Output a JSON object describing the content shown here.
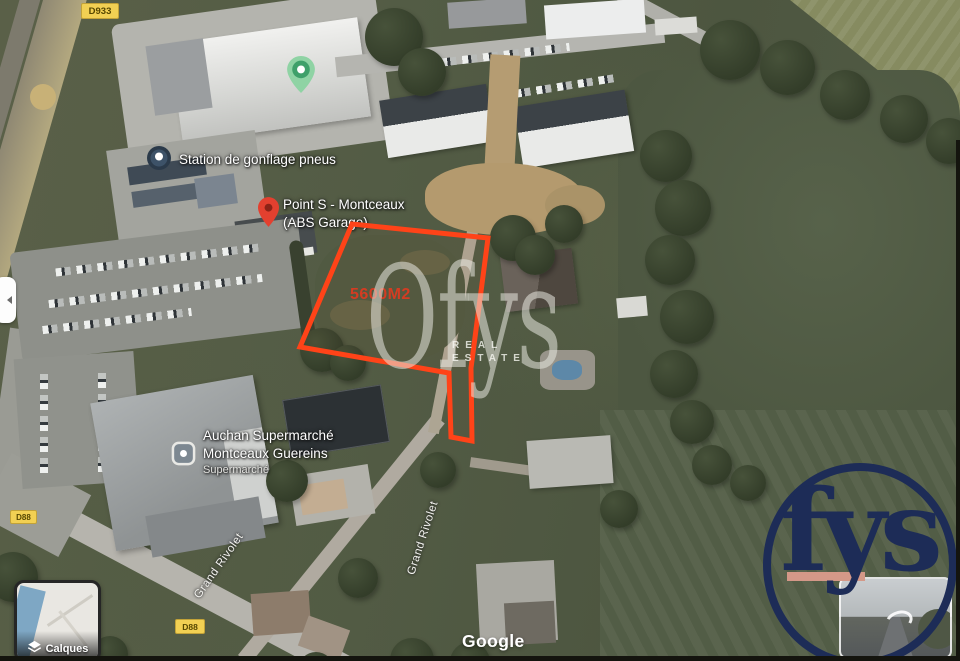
{
  "map": {
    "attribution": "Google",
    "area_label": "5600M2",
    "badges": {
      "d933": "D933",
      "d88_west": "D88",
      "d88_south": "D88"
    },
    "streets": {
      "grand_rivolet_sw": "Grand Rivolet",
      "grand_rivolet_n": "Grand Rivolet"
    },
    "places": {
      "station": {
        "name": "Station de gonflage pneus"
      },
      "point_s": {
        "line1": "Point S - Montceaux",
        "line2": "(ABS Garage)"
      },
      "auchan": {
        "line1": "Auchan Supermarché",
        "line2": "Montceaux Guereins",
        "category": "Supermarché"
      }
    }
  },
  "controls": {
    "layers_label": "Calques"
  },
  "watermark": {
    "brand": "Ofys",
    "tagline_word1": "REAL",
    "tagline_word2": "ESTATE"
  },
  "logo": {
    "wordmark": "fys"
  },
  "colors": {
    "plot_outline": "#ff4318",
    "area_label_red": "#e03a20",
    "badge_yellow": "#f2d053",
    "logo_navy": "#1d2c57",
    "logo_salmon": "#d49888"
  }
}
